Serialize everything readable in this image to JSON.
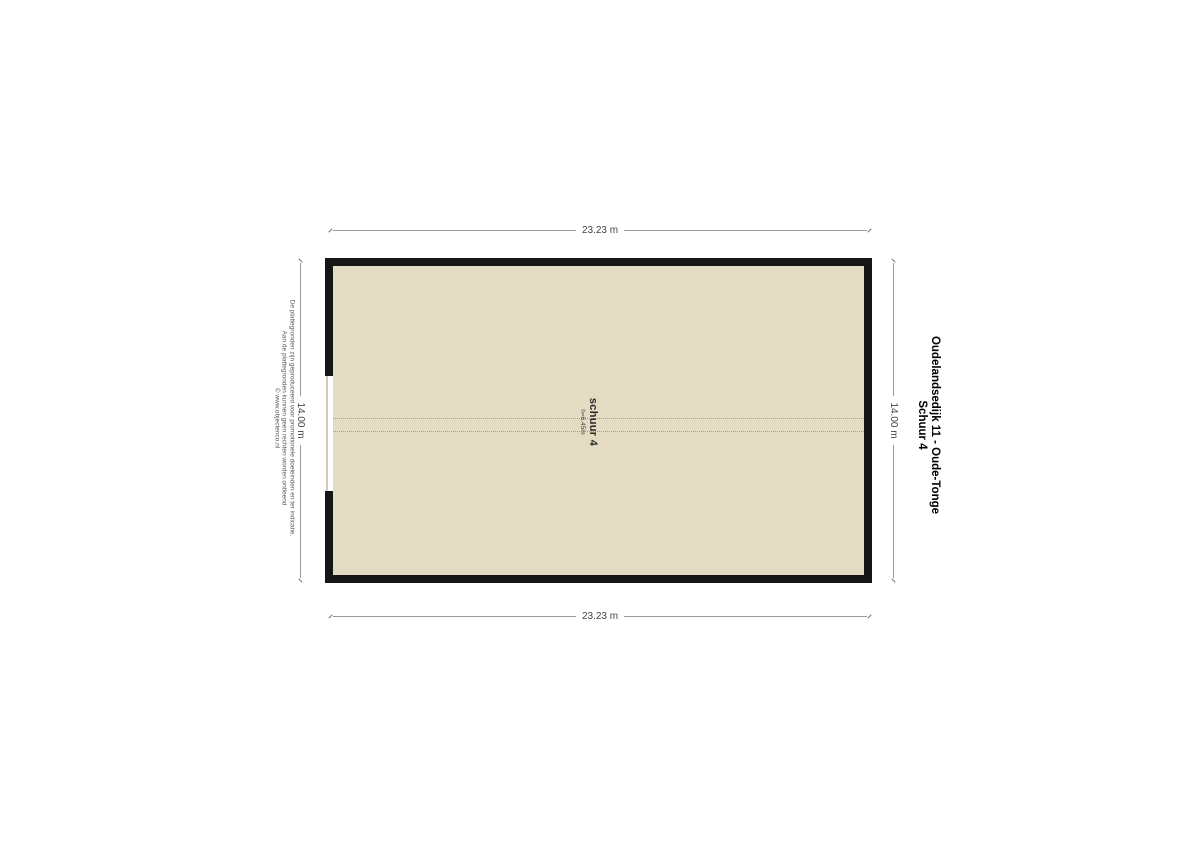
{
  "plan": {
    "room_label": "schuur 4",
    "room_height": "h=6.45m"
  },
  "dimensions": {
    "top": "23.23 m",
    "bottom": "23.23 m",
    "left": "14.00 m",
    "right": "14.00 m"
  },
  "title": {
    "line1": "Oudelandsedijk 11 - Oude-Tonge",
    "line2": "Schuur 4"
  },
  "disclaimer": {
    "lines": [
      "De plattegronden zijn geproduceerd voor promotionele doeleinden en ter indicatie.",
      "Aan de plattegronden kunnen geen rechten worden ontleend",
      "© www.objectenco.nl"
    ]
  },
  "colors": {
    "floor": "#e3dcc2",
    "wall": "#161616",
    "dim": "#999999"
  }
}
